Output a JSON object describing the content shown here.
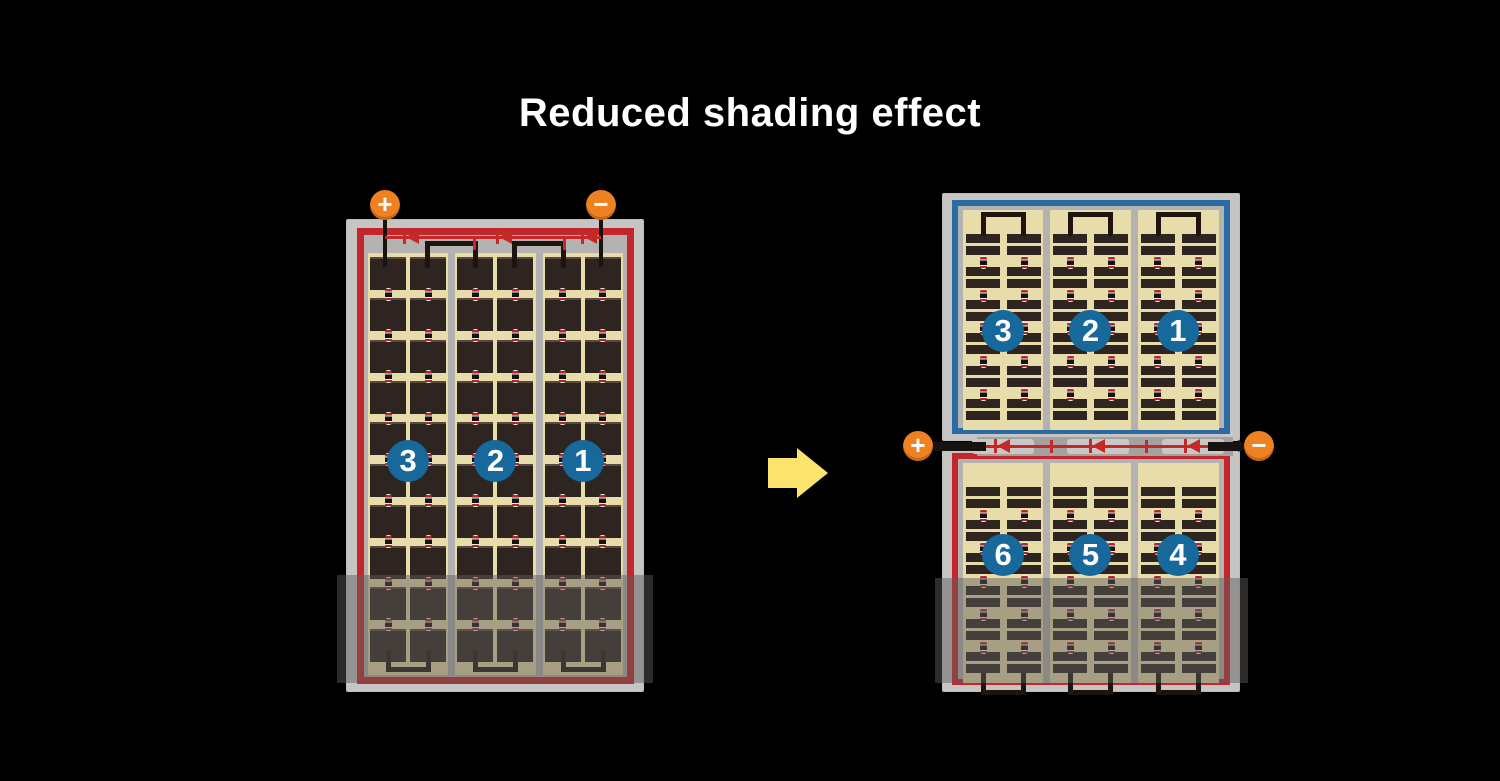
{
  "title": "Reduced shading effect",
  "terminals": {
    "plus_label": "+",
    "minus_label": "−"
  },
  "left_panel": {
    "section_labels": [
      "3",
      "2",
      "1"
    ],
    "bypass_diode_count": 3
  },
  "right_panel": {
    "top_section_labels": [
      "3",
      "2",
      "1"
    ],
    "bottom_section_labels": [
      "6",
      "5",
      "4"
    ],
    "bypass_diode_count": 3
  },
  "colors": {
    "background": "#000000",
    "title_text": "#ffffff",
    "panel_frame": "#c6c5c3",
    "panel_inner_gray": "#b5b3b1",
    "cell_field_tan": "#e8dcab",
    "cell_dark": "#2e2520",
    "cell_edge": "#5a4a3c",
    "divider_gray": "#b3b2b0",
    "busbar_black": "#1d140e",
    "wire_black": "#171310",
    "red_border": "#c1272d",
    "blue_border": "#2a6ba5",
    "circuit_red": "#c62828",
    "diode_box_gray": "#c9c8c6",
    "junction_gray": "#a3a2a0",
    "terminal_orange": "#ee8122",
    "number_circle_blue": "#17699c",
    "arrow_yellow": "#fbe36d",
    "shade_overlay": "rgba(95,92,90,0.48)"
  }
}
